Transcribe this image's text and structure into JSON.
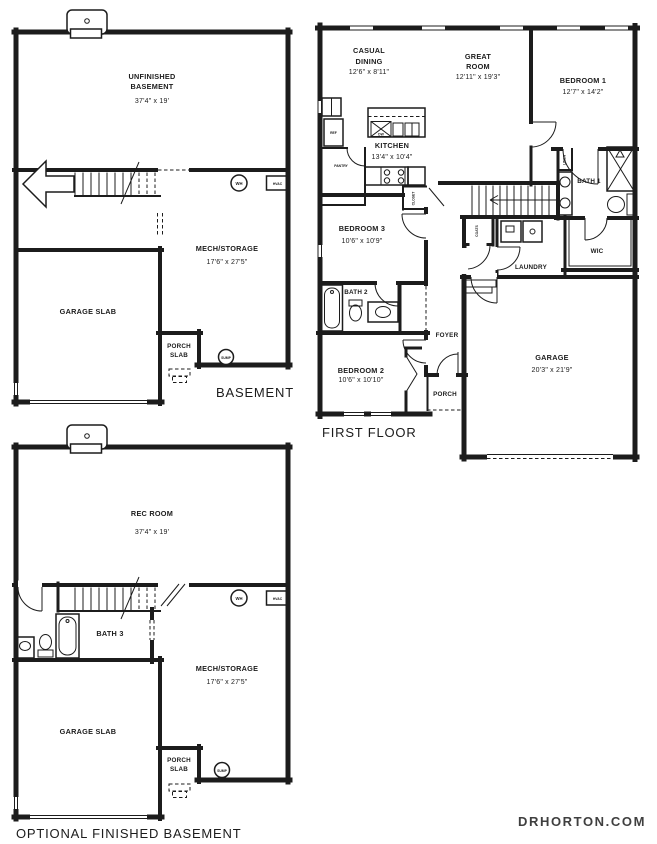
{
  "footer": {
    "website": "DRHORTON.COM"
  },
  "colors": {
    "wall": "#1c1c1c",
    "text": "#1c1c1c",
    "footer_text": "#3f3f3f",
    "background": "#ffffff"
  },
  "plans": {
    "basement": {
      "title": "BASEMENT",
      "rooms": {
        "unfinished": {
          "line1": "UNFINISHED",
          "line2": "BASEMENT",
          "dims": "37'4\" x 19'"
        },
        "mech": {
          "name": "MECH/STORAGE",
          "dims": "17'6\" x 27'5\""
        },
        "garage_slab": {
          "name": "GARAGE SLAB"
        },
        "porch_slab": {
          "line1": "PORCH",
          "line2": "SLAB"
        }
      },
      "equipment": {
        "wh": "WH",
        "hvac": "HVAC",
        "sump": "SUMP"
      }
    },
    "first_floor": {
      "title": "FIRST FLOOR",
      "rooms": {
        "casual_dining": {
          "line1": "CASUAL",
          "line2": "DINING",
          "dims": "12'6\" x 8'11\""
        },
        "great_room": {
          "line1": "GREAT",
          "line2": "ROOM",
          "dims": "12'11\" x 19'3\""
        },
        "bedroom1": {
          "name": "BEDROOM 1",
          "dims": "12'7\" x 14'2\""
        },
        "kitchen": {
          "name": "KITCHEN",
          "dims": "13'4\" x 10'4\""
        },
        "bedroom3": {
          "name": "BEDROOM 3",
          "dims": "10'6\" x 10'9\""
        },
        "bedroom2": {
          "name": "BEDROOM 2",
          "dims": "10'6\" x 10'10\""
        },
        "bath1": {
          "name": "BATH 1"
        },
        "bath2": {
          "name": "BATH 2"
        },
        "wic": {
          "name": "WIC"
        },
        "laundry": {
          "name": "LAUNDRY"
        },
        "foyer": {
          "name": "FOYER"
        },
        "porch": {
          "name": "PORCH"
        },
        "garage": {
          "name": "GARAGE",
          "dims": "20'3\" x 21'9\""
        }
      },
      "closets": {
        "pantry": "PANTRY",
        "ref": "REF",
        "linen": "LINEN",
        "coats": "COATS",
        "closet": "CLOSET",
        "dw": "DW"
      }
    },
    "optional_basement": {
      "title": "OPTIONAL FINISHED BASEMENT",
      "rooms": {
        "rec_room": {
          "name": "REC ROOM",
          "dims": "37'4\" x 19'"
        },
        "bath3": {
          "name": "BATH 3"
        },
        "mech": {
          "name": "MECH/STORAGE",
          "dims": "17'6\" x 27'5\""
        },
        "garage_slab": {
          "name": "GARAGE SLAB"
        },
        "porch_slab": {
          "line1": "PORCH",
          "line2": "SLAB"
        }
      },
      "equipment": {
        "wh": "WH",
        "hvac": "HVAC",
        "sump": "SUMP"
      }
    }
  }
}
